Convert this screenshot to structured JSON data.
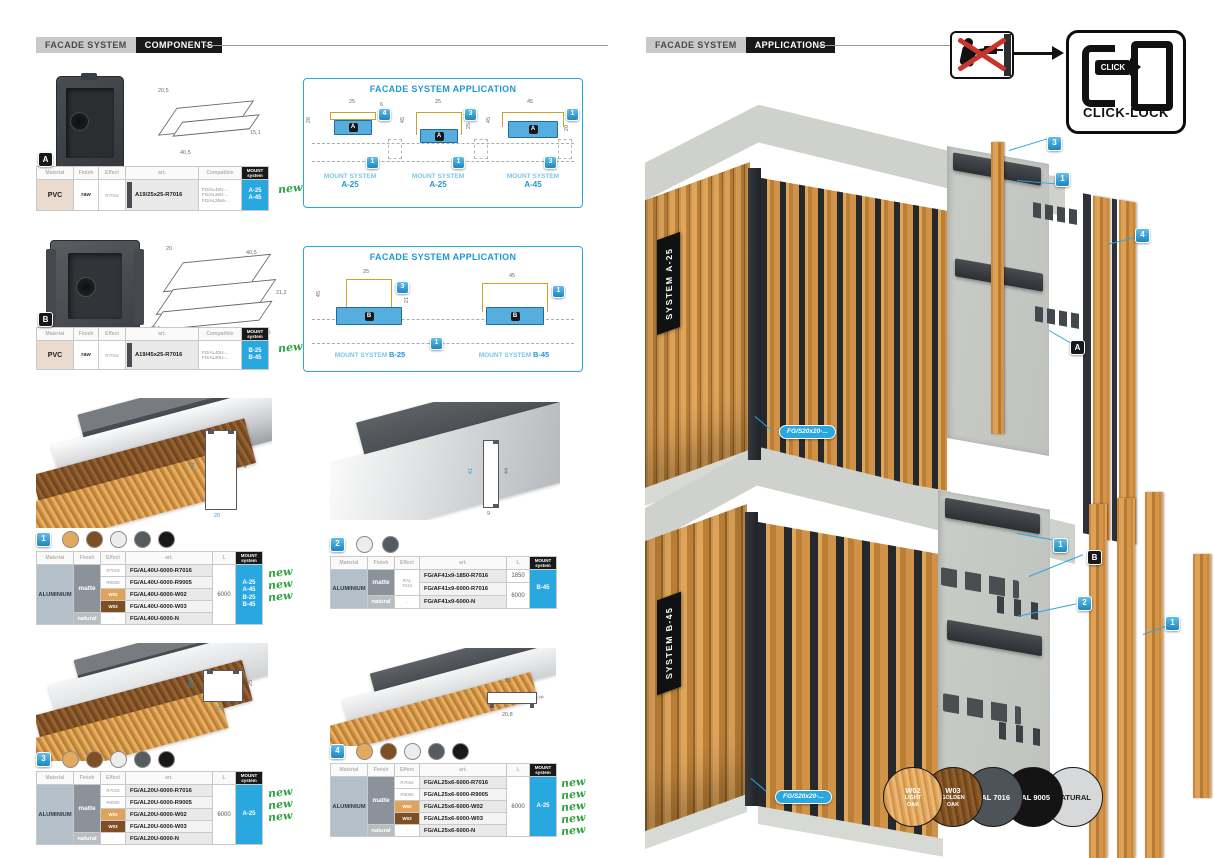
{
  "left": {
    "tab_primary": "FACADE SYSTEM",
    "tab_secondary": "COMPONENTS",
    "app_title": "FACADE SYSTEM APPLICATION",
    "new_label": "new",
    "thermal_label": "ALU thermal expansion",
    "thermal_value": "0,02mm/1m/1°C",
    "th": {
      "material": "Material",
      "finish": "Finish",
      "effect": "Effect",
      "art": "art.",
      "compatible": "Compatible",
      "len": "L",
      "mount_line1": "MOUNT",
      "mount_line2": "system"
    },
    "compA": {
      "badge": "A",
      "dim_top": "20,5",
      "dim_bottom": "40,5",
      "dim_right": "15,1",
      "material": "PVC",
      "finish": "raw",
      "effect": "R7016",
      "art": "A19/25x25-R7016",
      "compat1": "FG/AL40U-...",
      "compat2": "FG/AL20U-...",
      "compat3": "FG/AL25x6-...",
      "mount1": "A-25",
      "mount2": "A-45"
    },
    "appA": {
      "d1": {
        "dim_top": "25",
        "dim_left": "26",
        "dim_right": "6",
        "badge_top": "4",
        "badge_bottom": "1",
        "clip": "A",
        "label": "MOUNT SYSTEM",
        "system": "A-25"
      },
      "d2": {
        "dim_top": "25",
        "dim_left": "45",
        "dim_right": "25",
        "badge_top": "3",
        "badge_bottom": "1",
        "clip": "A",
        "label": "MOUNT SYSTEM",
        "system": "A-25"
      },
      "d3": {
        "dim_top": "45",
        "dim_left": "45",
        "dim_right": "20",
        "badge_top": "1",
        "badge_bottom": "3",
        "clip": "A",
        "label": "MOUNT SYSTEM",
        "system": "A-45"
      }
    },
    "compB": {
      "badge": "B",
      "dim_top_left": "20",
      "dim_top_right": "40,5",
      "dim_right": "21,2",
      "dim_bottom_left": "40,5",
      "dim_bottom_right": "40,5",
      "material": "PVC",
      "finish": "raw",
      "effect": "R7016",
      "art": "A19/45x25-R7016",
      "compat1": "FG/AL40U-...",
      "compat2": "FG/AL20U-...",
      "mount1": "B-25",
      "mount2": "B-45"
    },
    "appB": {
      "d1": {
        "dim_top": "25",
        "dim_left": "45",
        "dim_right": "21",
        "badge_top": "3",
        "clip": "B",
        "label": "MOUNT SYSTEM",
        "system": "B-25"
      },
      "d2": {
        "dim_top": "45",
        "badge_top": "1",
        "clip": "B",
        "label": "MOUNT SYSTEM",
        "system": "B-45"
      },
      "badge_bottom": "1"
    },
    "s1": {
      "badge": "1",
      "dim_left": "41",
      "dim_right": "45",
      "dim_bottom": "20",
      "material": "ALUMINIUM",
      "finish_matte": "matte",
      "finish_natural": "natural",
      "e1": "R7016",
      "e2": "R9005",
      "e3": "W02",
      "e4": "W03",
      "e5": "-",
      "a1": "FG/AL40U-6000-R7016",
      "a2": "FG/AL40U-6000-R9005",
      "a3": "FG/AL40U-6000-W02",
      "a4": "FG/AL40U-6000-W03",
      "a5": "FG/AL40U-6000-N",
      "len": "6000",
      "m1": "A-25",
      "m2": "A-45",
      "m3": "B-25",
      "m4": "B-45"
    },
    "s2": {
      "badge": "2",
      "dim_left": "41",
      "dim_right": "44",
      "dim_bottom": "9",
      "material": "ALUMINIUM",
      "finish_matte": "matte",
      "finish_natural": "natural",
      "e12_line1": "RAL",
      "e12_line2": "7016",
      "e3": "-",
      "a1": "FG/AF41x9-1850-R7016",
      "a2": "FG/AF41x9-6000-R7016",
      "a3": "FG/AF41x9-6000-N",
      "len1": "1850",
      "len23": "6000",
      "m1": "B-45"
    },
    "s3": {
      "badge": "3",
      "dim_left": "20,4",
      "dim_right": "25",
      "dim_bottom": "25",
      "material": "ALUMINIUM",
      "finish_matte": "matte",
      "finish_natural": "natural",
      "e1": "R7016",
      "e2": "R9005",
      "e3": "W02",
      "e4": "W03",
      "e5": "-",
      "a1": "FG/AL20U-6000-R7016",
      "a2": "FG/AL20U-6000-R9005",
      "a3": "FG/AL20U-6000-W02",
      "a4": "FG/AL20U-6000-W03",
      "a5": "FG/AL20U-6000-N",
      "len": "6000",
      "m1": "A-25"
    },
    "s4": {
      "badge": "4",
      "dim_top": "25",
      "dim_bottom": "20,8",
      "dim_right": "6",
      "material": "ALUMINIUM",
      "finish_matte": "matte",
      "finish_natural": "natural",
      "e1": "R7016",
      "e2": "R9005",
      "e3": "W02",
      "e4": "W03",
      "e5": "-",
      "a1": "FG/AL25x6-6000-R7016",
      "a2": "FG/AL25x6-6000-R9005",
      "a3": "FG/AL25x6-6000-W02",
      "a4": "FG/AL25x6-6000-W03",
      "a5": "FG/AL25x6-6000-N",
      "len": "6000",
      "m1": "A-25"
    }
  },
  "right": {
    "tab_primary": "FACADE SYSTEM",
    "tab_secondary": "APPLICATIONS",
    "click_badge": "CLICK",
    "click_lock_label": "CLICK-LOCK",
    "scene_top": {
      "system_label": "SYSTEM A-25",
      "badge_slat": "3",
      "badge_rail": "1",
      "badge_panel": "4",
      "badge_clip": "A",
      "part_label": "FG/S20x20-..."
    },
    "scene_bottom": {
      "system_label": "SYSTEM B-45",
      "badge_rail": "1",
      "badge_clip": "B",
      "badge_bracket": "2",
      "badge_slat": "1",
      "part_label": "FG/S20x20-..."
    },
    "swatches": [
      {
        "code": "W02",
        "name1": "LIGHT",
        "name2": "OAK",
        "color": "#dfa45c"
      },
      {
        "code": "W03",
        "name1": "GOLDEN",
        "name2": "OAK",
        "color": "#7d4f22"
      },
      {
        "code": "RAL 7016",
        "name1": "",
        "name2": "",
        "color": "#4d5358"
      },
      {
        "code": "RAL 9005",
        "name1": "",
        "name2": "",
        "color": "#141414"
      },
      {
        "code": "NATURAL",
        "name1": "",
        "name2": "",
        "color": "#d7d8d9"
      }
    ]
  }
}
